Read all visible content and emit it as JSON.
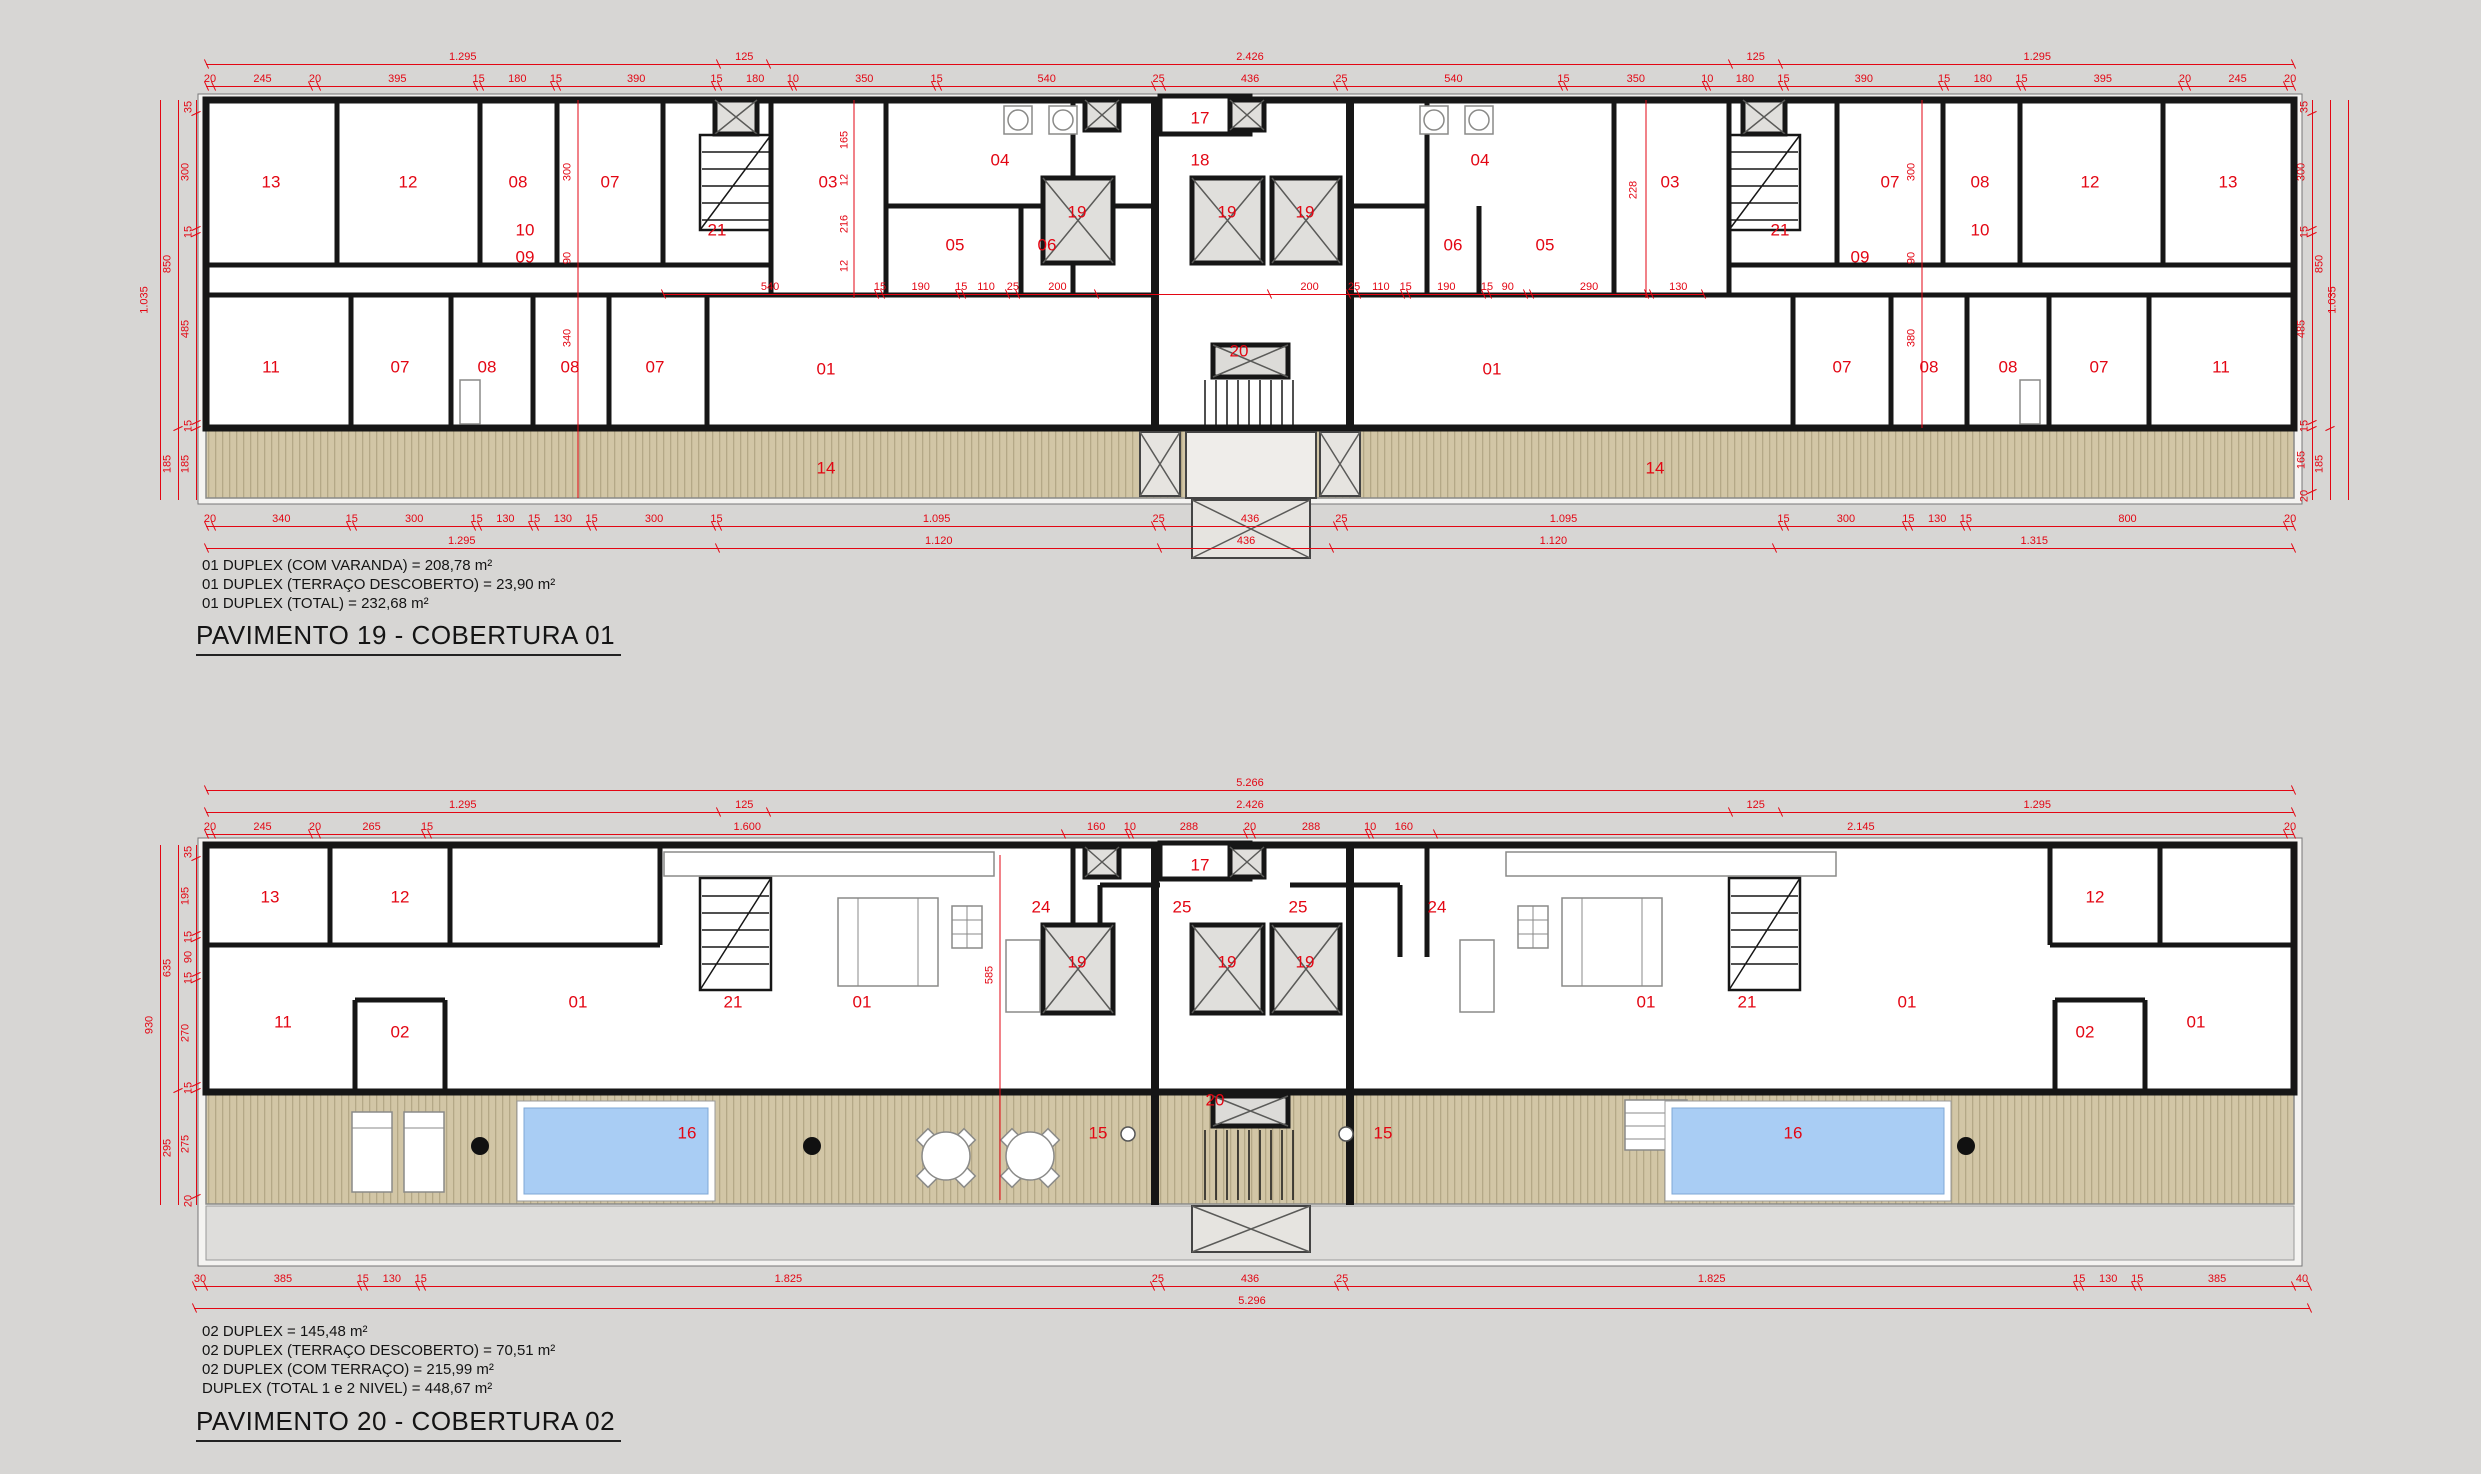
{
  "colors": {
    "background": "#d7d6d4",
    "dimension_red": "#e30613",
    "wall_black": "#161616",
    "deck_tan": "#d2c6a6",
    "pool_blue": "#a9cdf4",
    "shaft_gray": "#e0dfdc"
  },
  "plan1": {
    "title": "PAVIMENTO 19 - COBERTURA 01",
    "notes": [
      "01 DUPLEX (COM VARANDA) =  208,78 m²",
      "01 DUPLEX (TERRAÇO DESCOBERTO) = 23,90 m²",
      "01 DUPLEX (TOTAL) =  232,68 m²"
    ],
    "dimrows": [
      {
        "name": "p1-top-spans",
        "x": 206,
        "y": 50,
        "w": 2088,
        "segs": [
          "1.295",
          "125",
          "2.426",
          "125",
          "1.295"
        ]
      },
      {
        "name": "p1-top-detail",
        "x": 206,
        "y": 72,
        "w": 2088,
        "segs": [
          "20",
          "245",
          "20",
          "395",
          "15",
          "180",
          "15",
          "390",
          "15",
          "180",
          "10",
          "350",
          "15",
          "540",
          "25",
          "436",
          "25",
          "540",
          "15",
          "350",
          "10",
          "180",
          "15",
          "390",
          "15",
          "180",
          "15",
          "395",
          "20",
          "245",
          "20"
        ]
      },
      {
        "name": "p1-interior",
        "x": 663,
        "y": 280,
        "w": 1041,
        "segs": [
          "540",
          "15",
          "190",
          "15",
          "110",
          "25",
          "200",
          "436*",
          "200",
          "25",
          "110",
          "15",
          "190",
          "15",
          "90",
          "15*",
          "290",
          "15*",
          "130"
        ]
      },
      {
        "name": "p1-bottom-detail",
        "x": 206,
        "y": 512,
        "w": 2088,
        "segs": [
          "20",
          "340",
          "15",
          "300",
          "15",
          "130",
          "15",
          "130",
          "15",
          "300",
          "15",
          "1.095",
          "25",
          "436",
          "25",
          "1.095",
          "15",
          "300",
          "15",
          "130",
          "15",
          "800",
          "20"
        ]
      },
      {
        "name": "p1-bottom-spans",
        "x": 206,
        "y": 534,
        "w": 2088,
        "segs": [
          "1.295",
          "1.120",
          "436",
          "1.120",
          "1.315"
        ]
      }
    ],
    "dimcols": [
      {
        "name": "p1-left-overall",
        "x": 146,
        "y": 100,
        "h": 400,
        "segs": [
          "1.035"
        ]
      },
      {
        "name": "p1-left-mid",
        "x": 164,
        "y": 100,
        "h": 400,
        "segs": [
          "850",
          "185"
        ]
      },
      {
        "name": "p1-left-detail",
        "x": 182,
        "y": 100,
        "h": 400,
        "segs": [
          "35",
          "300",
          "15",
          "485",
          "15",
          "185"
        ]
      },
      {
        "name": "p1-right-detail",
        "x": 2298,
        "y": 100,
        "h": 400,
        "segs": [
          "35",
          "300",
          "15",
          "485",
          "15",
          "165",
          "20"
        ]
      },
      {
        "name": "p1-right-mid",
        "x": 2316,
        "y": 100,
        "h": 400,
        "segs": [
          "850",
          "185"
        ]
      },
      {
        "name": "p1-right-overall",
        "x": 2334,
        "y": 100,
        "h": 400,
        "segs": [
          "1.035"
        ]
      }
    ],
    "vlabels": [
      [
        "300",
        568,
        172
      ],
      [
        "90",
        568,
        258
      ],
      [
        "340",
        568,
        338
      ],
      [
        "165",
        845,
        140
      ],
      [
        "12",
        845,
        180
      ],
      [
        "216",
        845,
        224
      ],
      [
        "12",
        845,
        266
      ],
      [
        "228",
        1634,
        190
      ],
      [
        "300",
        1912,
        172
      ],
      [
        "90",
        1912,
        258
      ],
      [
        "380",
        1912,
        338
      ]
    ],
    "rooms": [
      [
        "13",
        271,
        182
      ],
      [
        "12",
        408,
        182
      ],
      [
        "08",
        518,
        182
      ],
      [
        "07",
        610,
        182
      ],
      [
        "10",
        525,
        230
      ],
      [
        "09",
        525,
        257
      ],
      [
        "21",
        717,
        230
      ],
      [
        "03",
        828,
        182
      ],
      [
        "04",
        1000,
        160
      ],
      [
        "05",
        955,
        245
      ],
      [
        "06",
        1047,
        245
      ],
      [
        "19",
        1077,
        212
      ],
      [
        "19",
        1227,
        212
      ],
      [
        "19",
        1305,
        212
      ],
      [
        "17",
        1200,
        118
      ],
      [
        "18",
        1200,
        160
      ],
      [
        "04",
        1480,
        160
      ],
      [
        "06",
        1453,
        245
      ],
      [
        "05",
        1545,
        245
      ],
      [
        "03",
        1670,
        182
      ],
      [
        "21",
        1780,
        230
      ],
      [
        "09",
        1860,
        257
      ],
      [
        "07",
        1890,
        182
      ],
      [
        "08",
        1980,
        182
      ],
      [
        "10",
        1980,
        230
      ],
      [
        "12",
        2090,
        182
      ],
      [
        "13",
        2228,
        182
      ],
      [
        "11",
        271,
        367
      ],
      [
        "07",
        400,
        367
      ],
      [
        "08",
        487,
        367
      ],
      [
        "08",
        570,
        367
      ],
      [
        "07",
        655,
        367
      ],
      [
        "01",
        826,
        369
      ],
      [
        "20",
        1239,
        351
      ],
      [
        "01",
        1492,
        369
      ],
      [
        "07",
        1842,
        367
      ],
      [
        "08",
        1929,
        367
      ],
      [
        "08",
        2008,
        367
      ],
      [
        "07",
        2099,
        367
      ],
      [
        "11",
        2221,
        367
      ],
      [
        "14",
        826,
        468
      ],
      [
        "14",
        1655,
        468
      ]
    ]
  },
  "plan2": {
    "title": "PAVIMENTO 20 - COBERTURA 02",
    "notes": [
      "02 DUPLEX = 145,48 m²",
      "02 DUPLEX (TERRAÇO DESCOBERTO) = 70,51 m²",
      "02 DUPLEX (COM TERRAÇO) = 215,99 m²",
      "DUPLEX (TOTAL 1 e 2 NIVEL) = 448,67 m²"
    ],
    "dimrows": [
      {
        "name": "p2-top-overall",
        "x": 206,
        "y": 776,
        "w": 2088,
        "segs": [
          "5.266"
        ]
      },
      {
        "name": "p2-top-spans",
        "x": 206,
        "y": 798,
        "w": 2088,
        "segs": [
          "1.295",
          "125",
          "2.426",
          "125",
          "1.295"
        ]
      },
      {
        "name": "p2-top-detail",
        "x": 206,
        "y": 820,
        "w": 2088,
        "segs": [
          "20",
          "245",
          "20",
          "265",
          "15",
          "1.600",
          "160",
          "10",
          "288",
          "20",
          "288",
          "10",
          "160",
          "2.145",
          "20"
        ]
      },
      {
        "name": "p2-bottom-detail",
        "x": 194,
        "y": 1272,
        "w": 2116,
        "segs": [
          "30",
          "385",
          "15",
          "130",
          "15",
          "1.825",
          "25",
          "436",
          "25",
          "1.825",
          "15",
          "130",
          "15",
          "385",
          "40"
        ]
      },
      {
        "name": "p2-bottom-overall",
        "x": 194,
        "y": 1294,
        "w": 2116,
        "segs": [
          "5.296"
        ]
      }
    ],
    "dimcols": [
      {
        "name": "p2-left-overall",
        "x": 146,
        "y": 845,
        "h": 360,
        "segs": [
          "930"
        ]
      },
      {
        "name": "p2-left-mid",
        "x": 164,
        "y": 845,
        "h": 360,
        "segs": [
          "635",
          "295"
        ]
      },
      {
        "name": "p2-left-detail",
        "x": 182,
        "y": 845,
        "h": 360,
        "segs": [
          "35",
          "195",
          "15",
          "90",
          "15",
          "270",
          "15",
          "275",
          "20"
        ]
      }
    ],
    "vlabels": [
      [
        "585",
        990,
        975
      ]
    ],
    "rooms": [
      [
        "13",
        270,
        897
      ],
      [
        "12",
        400,
        897
      ],
      [
        "11",
        283,
        1022
      ],
      [
        "02",
        400,
        1032
      ],
      [
        "01",
        578,
        1002
      ],
      [
        "21",
        733,
        1002
      ],
      [
        "01",
        862,
        1002
      ],
      [
        "24",
        1041,
        907
      ],
      [
        "25",
        1182,
        907
      ],
      [
        "17",
        1200,
        865
      ],
      [
        "25",
        1298,
        907
      ],
      [
        "24",
        1437,
        907
      ],
      [
        "19",
        1077,
        962
      ],
      [
        "19",
        1227,
        962
      ],
      [
        "19",
        1305,
        962
      ],
      [
        "20",
        1215,
        1100
      ],
      [
        "01",
        1646,
        1002
      ],
      [
        "21",
        1747,
        1002
      ],
      [
        "01",
        1907,
        1002
      ],
      [
        "12",
        2095,
        897
      ],
      [
        "02",
        2085,
        1032
      ],
      [
        "01",
        2196,
        1022
      ],
      [
        "16",
        687,
        1133
      ],
      [
        "15",
        1098,
        1133
      ],
      [
        "15",
        1383,
        1133
      ],
      [
        "16",
        1793,
        1133
      ]
    ]
  }
}
